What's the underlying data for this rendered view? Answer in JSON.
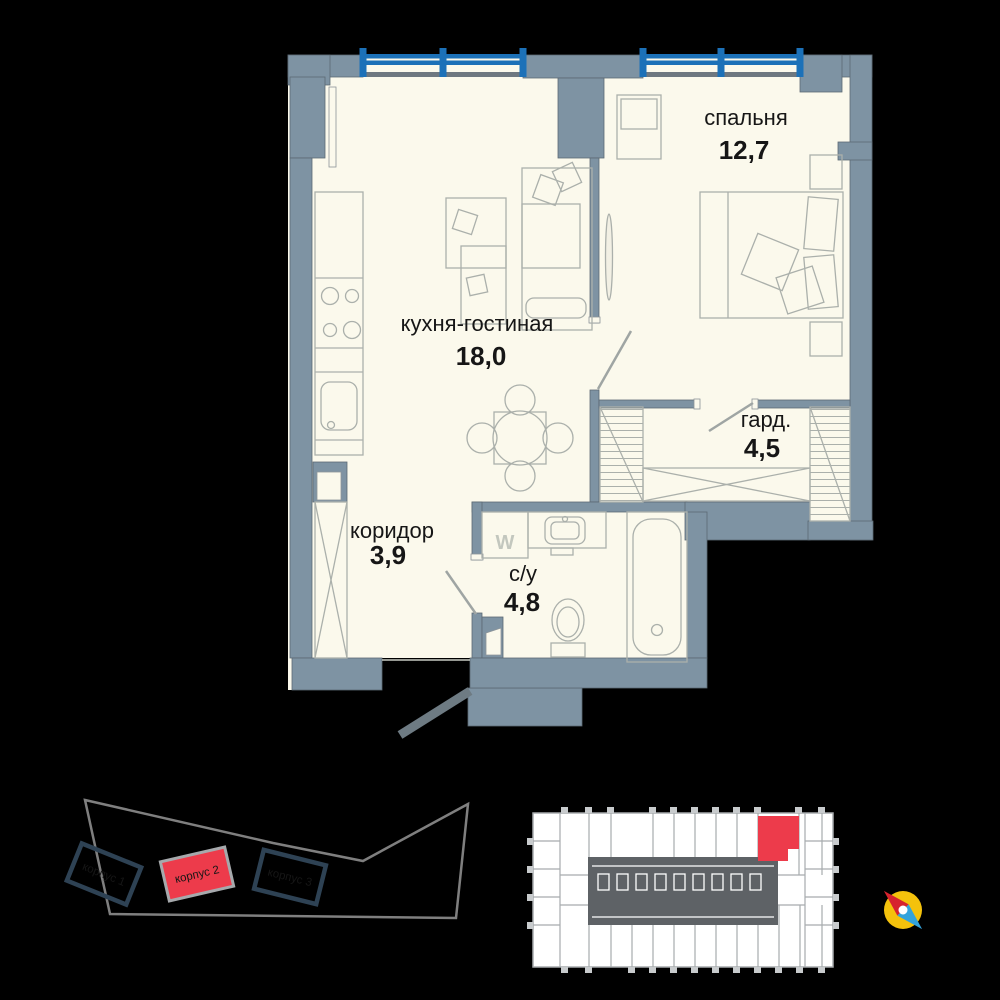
{
  "floor_plan": {
    "rooms": [
      {
        "name": "кухня-гостиная",
        "area": "18,0"
      },
      {
        "name": "спальня",
        "area": "12,7"
      },
      {
        "name": "гард.",
        "area": "4,5"
      },
      {
        "name": "коридор",
        "area": "3,9"
      },
      {
        "name": "с/у",
        "area": "4,8"
      }
    ],
    "washer_label": "W"
  },
  "site_plan": {
    "buildings": [
      {
        "label": "корпус 1",
        "highlighted": false
      },
      {
        "label": "корпус 2",
        "highlighted": true
      },
      {
        "label": "корпус 3",
        "highlighted": false
      }
    ]
  },
  "colors": {
    "wall": "#7E93A3",
    "floor": "#FBF9EC",
    "window_blue": "#1C71B8",
    "highlight_red": "#ED3B4B",
    "building_outline": "#2E4254",
    "compass_yellow": "#F4C20C",
    "compass_red": "#D6232E",
    "compass_blue": "#33A3DC"
  }
}
